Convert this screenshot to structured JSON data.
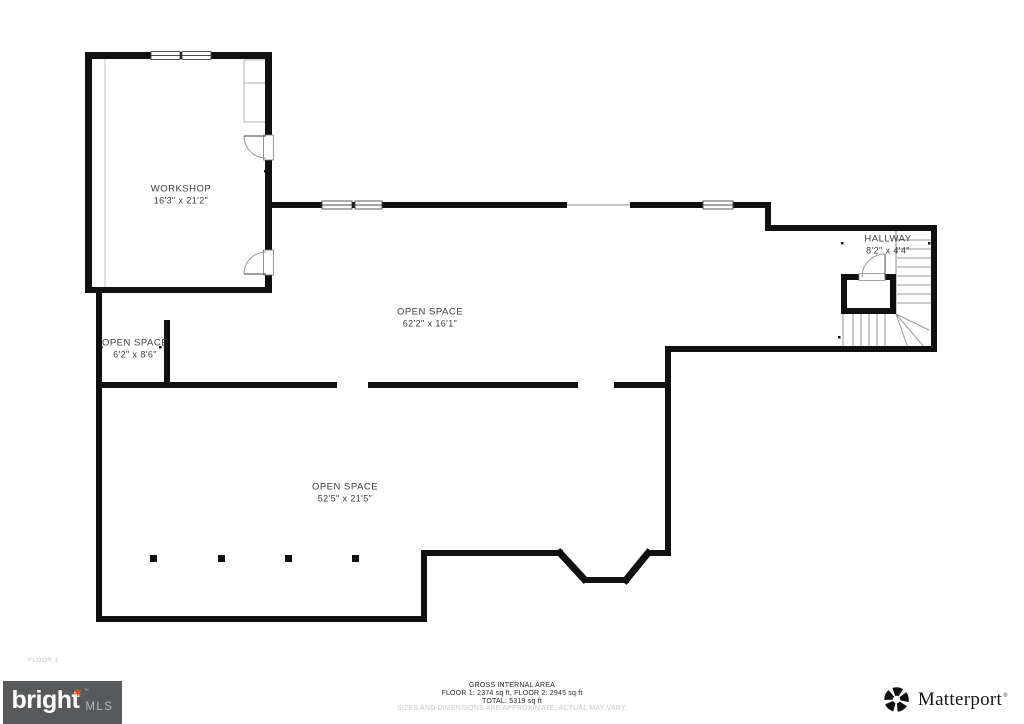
{
  "meta": {
    "floor_label": "FLOOR 1"
  },
  "rooms": {
    "workshop": {
      "name": "WORKSHOP",
      "dims": "16'3\" x 21'2\""
    },
    "open_mid": {
      "name": "OPEN SPACE",
      "dims": "62'2\" x 16'1\""
    },
    "open_small": {
      "name": "OPEN SPACE",
      "dims": "6'2\" x 8'6\""
    },
    "hallway": {
      "name": "HALLWAY",
      "dims": "8'2\" x 4'4\""
    },
    "open_bottom": {
      "name": "OPEN SPACE",
      "dims": "52'5\" x 21'5\""
    }
  },
  "footer": {
    "area_title": "GROSS INTERNAL AREA",
    "area_floors": "FLOOR 1: 2374 sq ft, FLOOR 2: 2945 sq ft",
    "area_total": "TOTAL: 5319 sq ft",
    "disclaimer": "SIZES AND DIMENSIONS ARE APPROXIMATE, ACTUAL MAY VARY."
  },
  "branding": {
    "bright": {
      "word": "bright",
      "star": "✱",
      "tm": "™",
      "suffix": "MLS"
    },
    "matterport": {
      "word": "Matterport",
      "reg": "®"
    }
  },
  "colors": {
    "wall": "#101010",
    "accent": "#e0562a",
    "logo_bg": "#58595b"
  }
}
